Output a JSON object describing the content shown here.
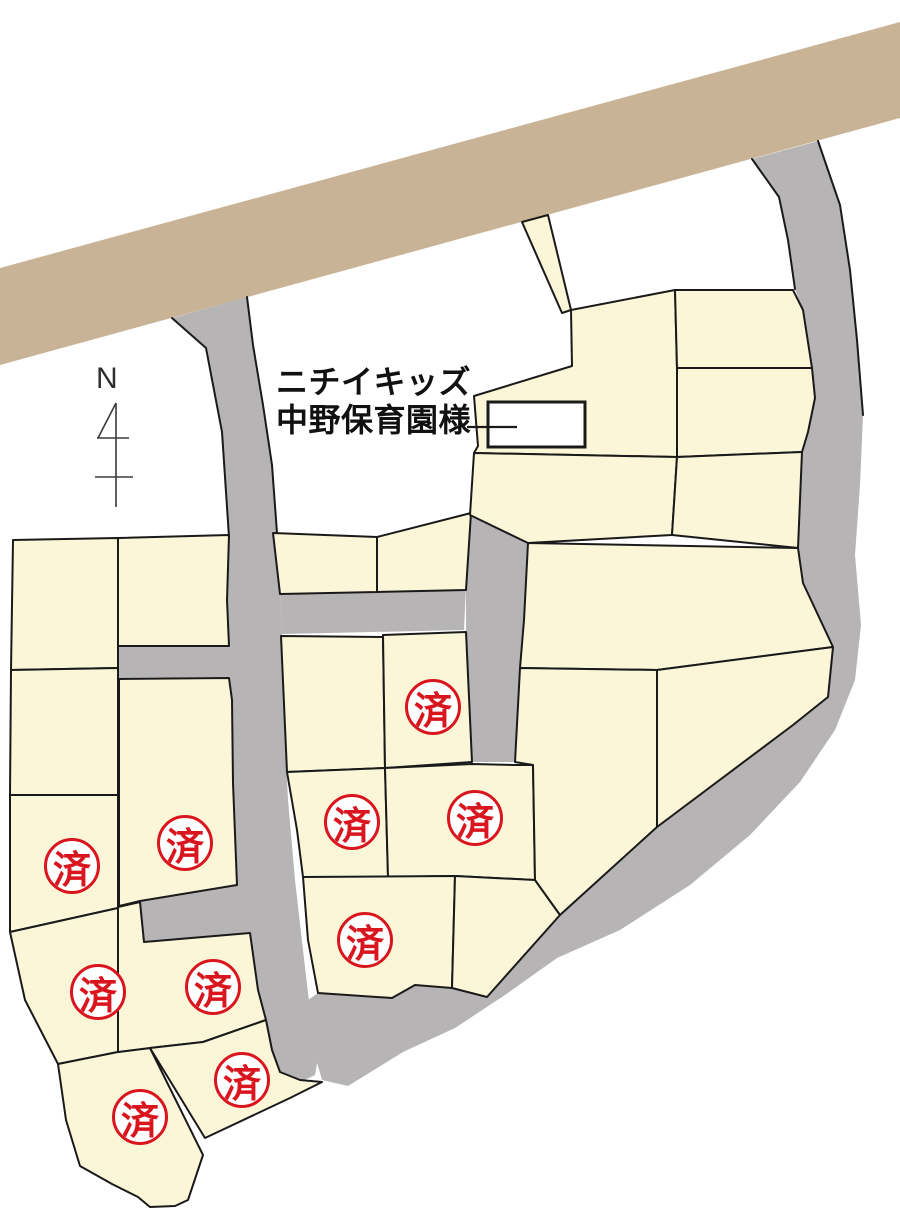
{
  "map": {
    "compass_label": "N",
    "annotation": {
      "line1": "ニチイキッズ",
      "line2": "中野保育園様"
    },
    "sold_badge": {
      "label": "済",
      "count": 10,
      "positions": [
        {
          "x": 433,
          "y": 707
        },
        {
          "x": 352,
          "y": 822
        },
        {
          "x": 475,
          "y": 818
        },
        {
          "x": 185,
          "y": 843
        },
        {
          "x": 72,
          "y": 866
        },
        {
          "x": 365,
          "y": 940
        },
        {
          "x": 213,
          "y": 987
        },
        {
          "x": 98,
          "y": 992
        },
        {
          "x": 242,
          "y": 1080
        },
        {
          "x": 140,
          "y": 1117
        }
      ]
    }
  },
  "colors": {
    "background": "#FFFFFF",
    "lot_fill": "#FBF6D8",
    "road_fill": "#B6B4B5",
    "band_fill": "#C9B396",
    "outline": "#1A1A1A",
    "badge_red": "#D9151E",
    "text": "#111111"
  }
}
